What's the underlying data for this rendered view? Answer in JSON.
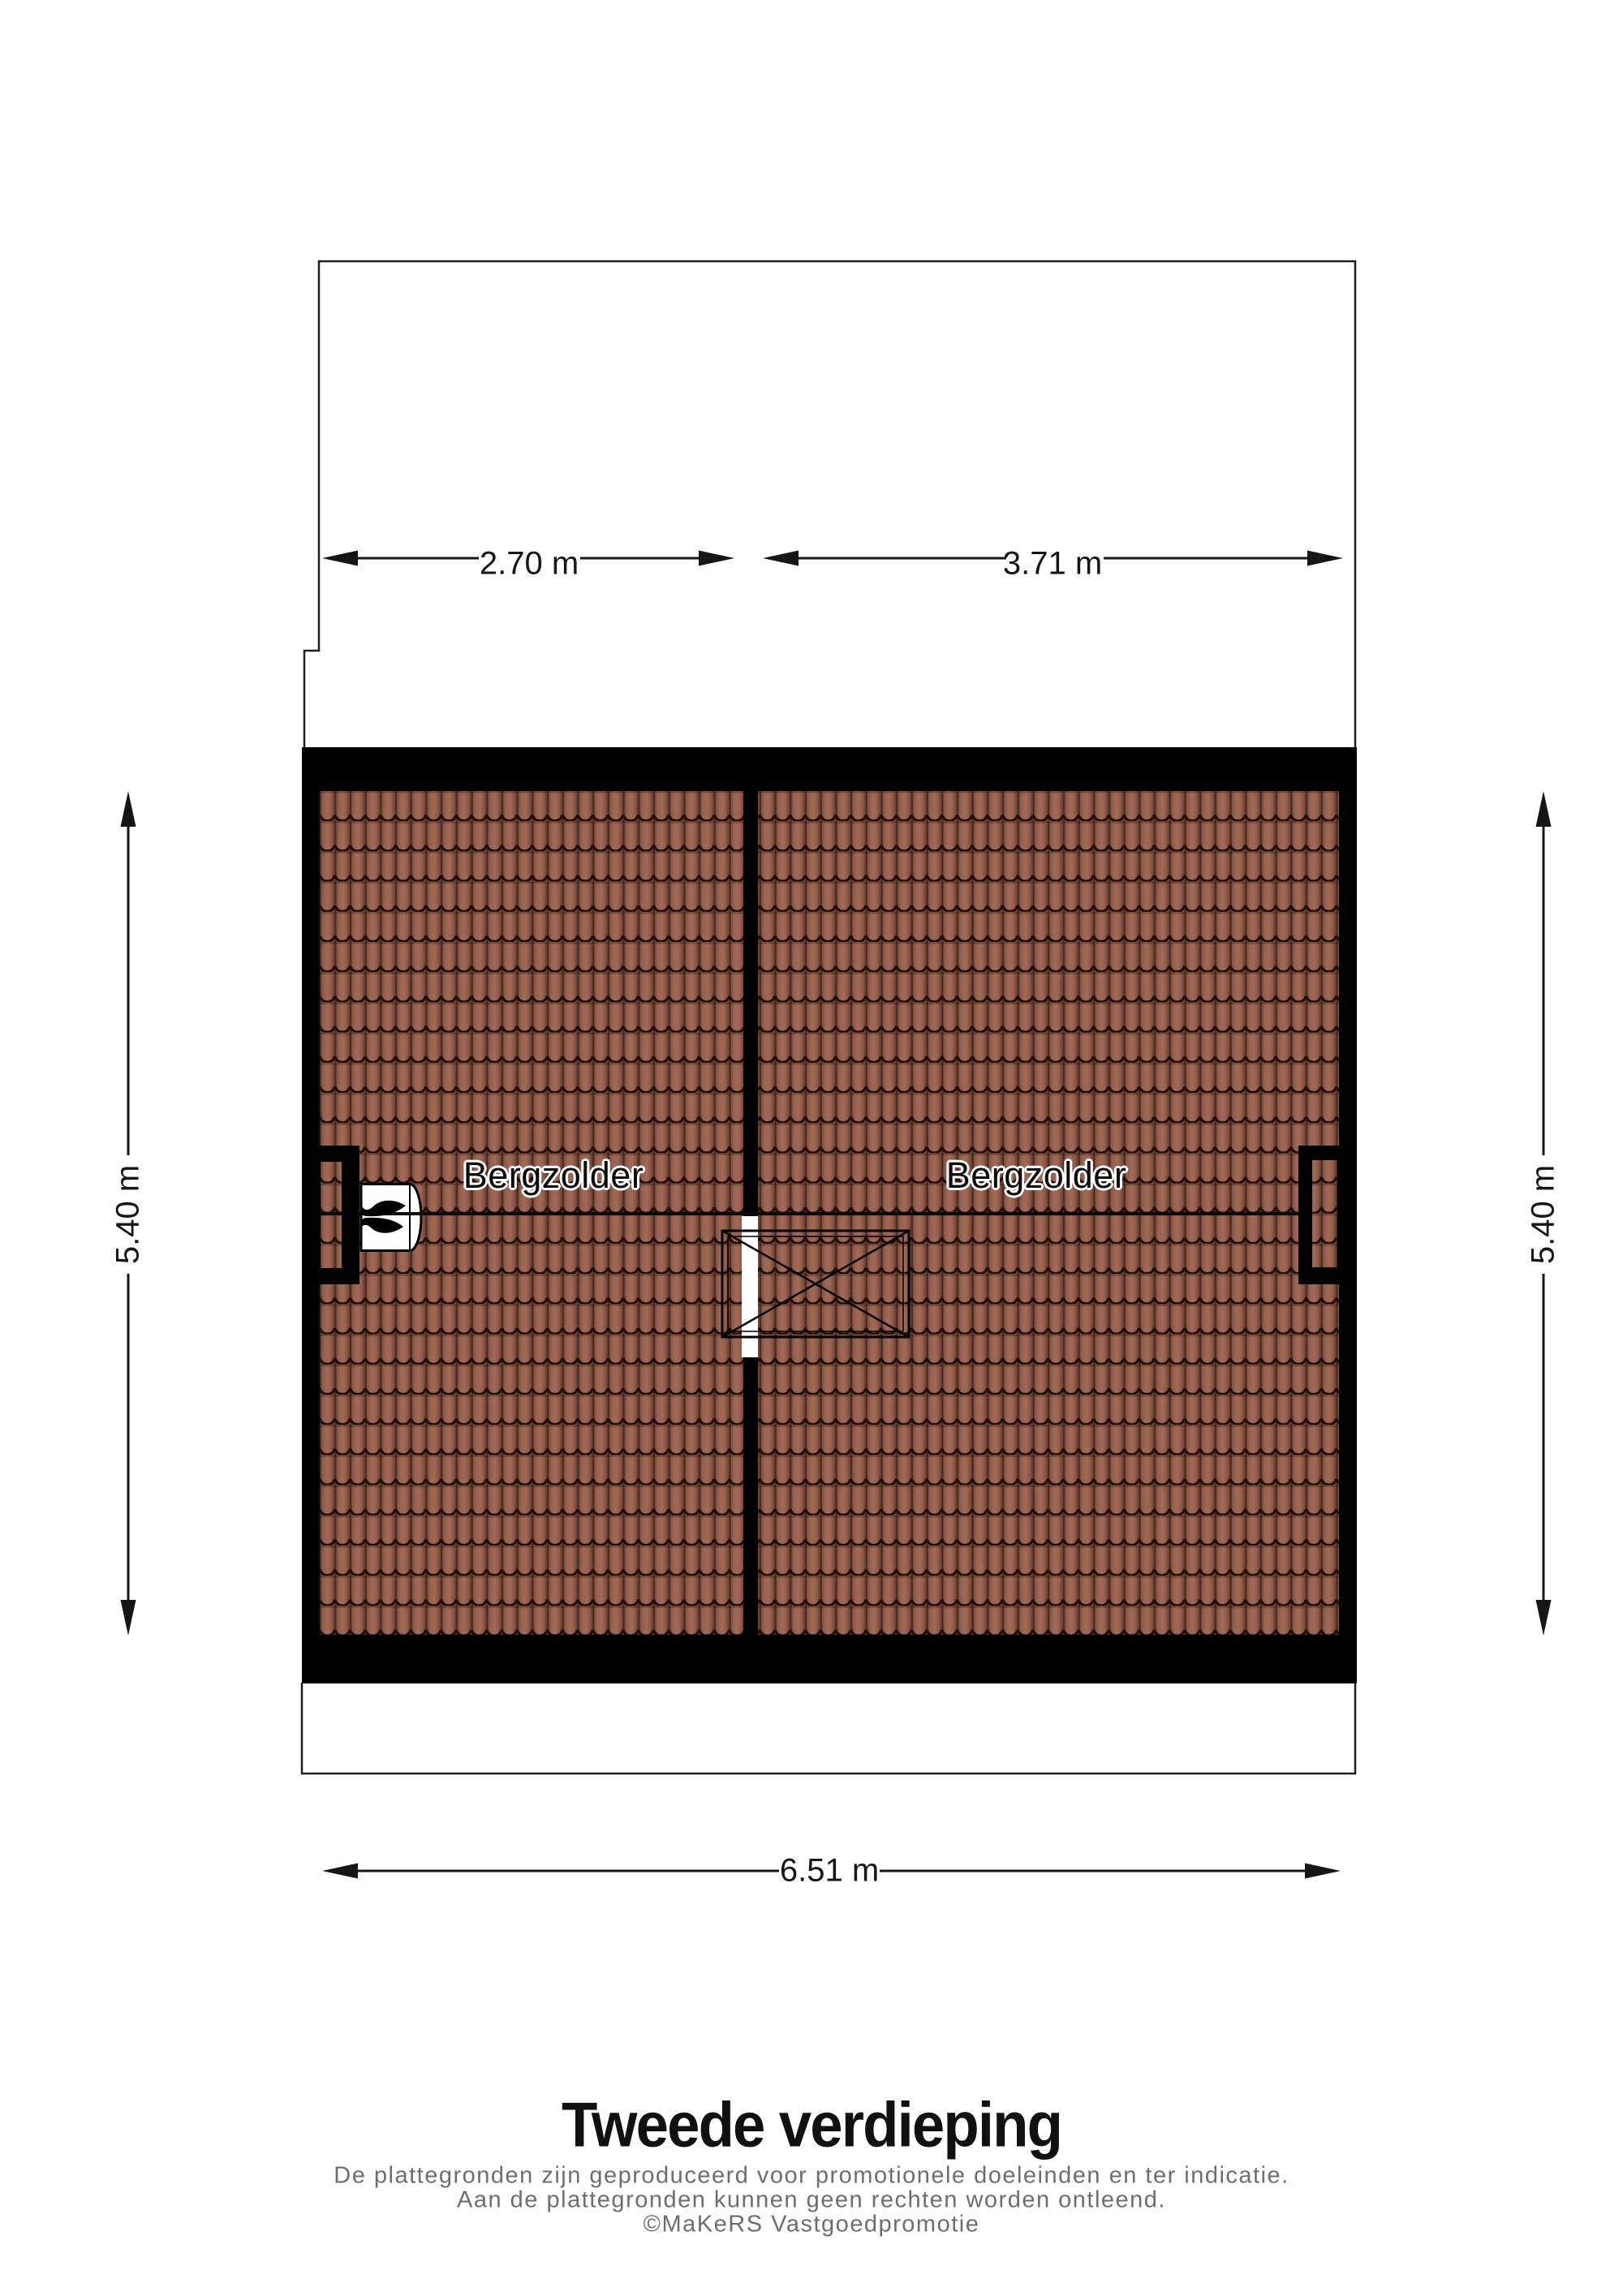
{
  "floor_plan": {
    "rooms": [
      {
        "label": "Bergzolder"
      },
      {
        "label": "Bergzolder"
      }
    ],
    "dimensions": {
      "top_left_width": "2.70 m",
      "top_right_width": "3.71 m",
      "side_left_height": "5.40 m",
      "side_right_height": "5.40 m",
      "bottom_width": "6.51 m"
    },
    "icons": [
      {
        "name": "flame-icon",
        "meaning": "central heating boiler symbol"
      }
    ],
    "colors": {
      "wall": "#000000",
      "tile_base": "#996350",
      "tile_highlight": "#a16a55",
      "tile_shadow": "#5f3b2e",
      "tile_wave_line": "#1d0d07",
      "outline": "#1f1f1f",
      "dimension_line": "#161616",
      "title_text": "#111111",
      "disclaimer_text": "#6e6e6e"
    }
  },
  "footer": {
    "title": "Tweede verdieping",
    "disclaimer": [
      "De plattegronden zijn geproduceerd voor promotionele doeleinden en ter indicatie.",
      "Aan de plattegronden kunnen geen rechten worden ontleend.",
      "©MaKeRS Vastgoedpromotie"
    ]
  }
}
